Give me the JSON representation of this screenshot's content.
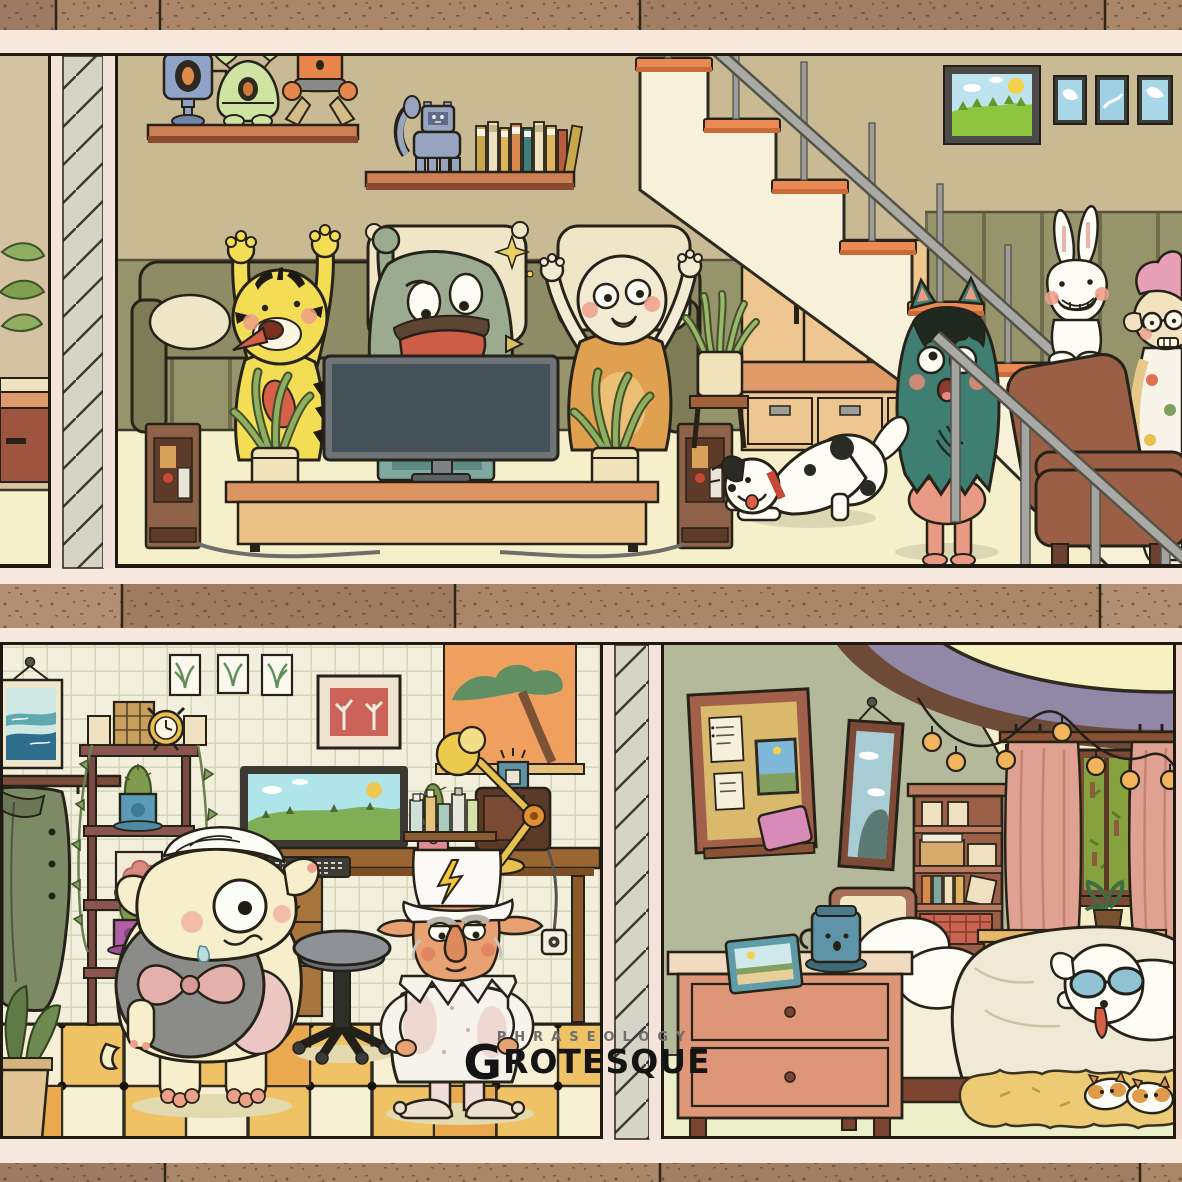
{
  "watermark": {
    "tagline": "PHRASEOLOGY",
    "brand_initial": "G",
    "brand_rest": "ROTESQUE"
  },
  "palette": {
    "concrete_slab": "#ab8769",
    "slab_cream": "#f6e8dc",
    "ink_outline": "#262218",
    "living_wall_tan": "#c9ba94",
    "living_wall_olive": "#96946a",
    "living_floor": "#f5efca",
    "stair_tread_orange": "#e98a52",
    "stair_stringer": "#f7f1da",
    "handrail_gray": "#a9a9a5",
    "shelf_orange": "#cd8054",
    "cabinet_tan": "#eec68f",
    "yellow_monster": "#f2dd55",
    "green_monster": "#9aab90",
    "cream_monster_body": "#dfa050",
    "teal_monster": "#3f7f72",
    "armchair_brown": "#9a5f45",
    "study_wall": "#f2efdd",
    "tile_yellow": "#f0c266",
    "tile_cream": "#f7efd4",
    "bedroom_sage": "#b5b99b",
    "bedroom_cream": "#f8eec7",
    "ceiling_purple": "#9187a6",
    "curtain_pink": "#dfa191",
    "dresser_salmon": "#dd9678",
    "rug_yellow": "#edca74"
  },
  "scene": {
    "upper_floor": {
      "room": "living-room",
      "items": [
        "toy-shelf-robots",
        "toy-shelf-books",
        "robot-cat-toy",
        "landscape-painting",
        "small-blue-frames",
        "staircase",
        "handrail",
        "understair-cabinet",
        "sofa",
        "tv",
        "media-console",
        "tower-speakers",
        "potted-plants",
        "snake-plant",
        "yellow-striped-monster",
        "green-big-mouth-monster",
        "cream-hooded-monster",
        "teal-furry-monster",
        "spotted-dog",
        "white-rabbit",
        "brown-armchair",
        "pink-haired-monster"
      ]
    },
    "lower_left": {
      "room": "study",
      "items": [
        "seascape-picture",
        "botanical-prints",
        "red-tree-art",
        "orange-tree-poster",
        "coat-rack",
        "ladder-shelf",
        "alarm-clock",
        "woven-basket",
        "cactus-pots",
        "desk",
        "computer-monitor",
        "keyboard",
        "desk-lamp",
        "radio",
        "bottle-shelf",
        "office-stool",
        "power-outlet",
        "one-eyed-shell-monster",
        "gnome-wizard-paper-hat",
        "checkered-floor"
      ]
    },
    "lower_right": {
      "room": "bedroom",
      "items": [
        "ceiling-oval-lamp",
        "string-lights",
        "cork-board",
        "pinned-notes",
        "pink-tablet",
        "wall-mirror",
        "bookshelf",
        "window-greenery",
        "pink-curtains",
        "sill-plant",
        "sideboard",
        "bed",
        "pillows",
        "duvet",
        "dog-with-goggles",
        "nightstand",
        "photo-frame",
        "face-mug",
        "fuzzy-rug",
        "corgi-slippers"
      ]
    }
  }
}
